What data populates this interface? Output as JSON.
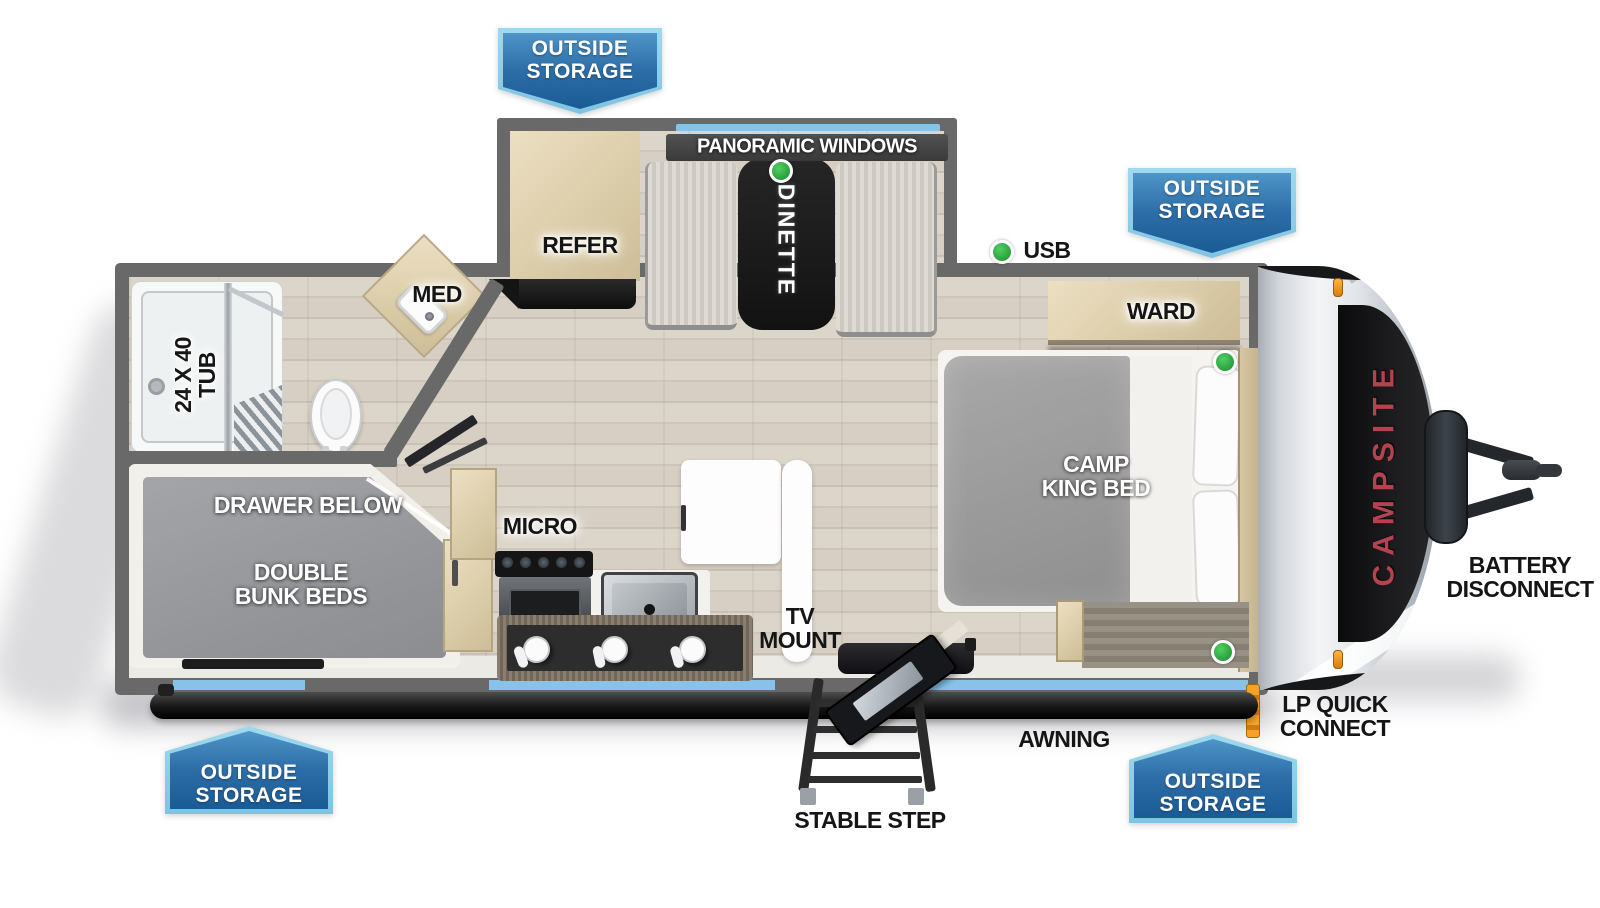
{
  "image_type": "travel trailer floor plan, top-down view",
  "brand": {
    "name_label": "CAMPSITE",
    "color": "#b2434f"
  },
  "badge": {
    "line1": "OUTSIDE",
    "line2": "STORAGE",
    "fill_top": "#4e95c8",
    "fill_bottom": "#1b5b95",
    "border": "#9fd9ee",
    "count": 4
  },
  "features": {
    "panoramic_windows": "PANORAMIC WINDOWS",
    "dinette": "DINETTE",
    "refer": "REFER",
    "usb": "USB",
    "ward": "WARD",
    "med": "MED",
    "tub_size": "24 X 40",
    "tub": "TUB",
    "camp": "CAMP",
    "king_bed": "KING BED",
    "drawer_below": "DRAWER BELOW",
    "double": "DOUBLE",
    "bunk_beds": "BUNK BEDS",
    "micro": "MICRO",
    "tv": "TV",
    "mount": "MOUNT",
    "battery": "BATTERY",
    "disconnect": "DISCONNECT",
    "lp_quick": "LP QUICK",
    "connect": "CONNECT",
    "awning": "AWNING",
    "stable_step": "STABLE STEP"
  },
  "indicators": {
    "led_color": "#2aa03c",
    "led_count": 4
  },
  "colors": {
    "window_blue": "#88c2e8",
    "wall_gray": "#696969",
    "lp_orange": "#ef9421",
    "brand_red": "#b2434f"
  }
}
